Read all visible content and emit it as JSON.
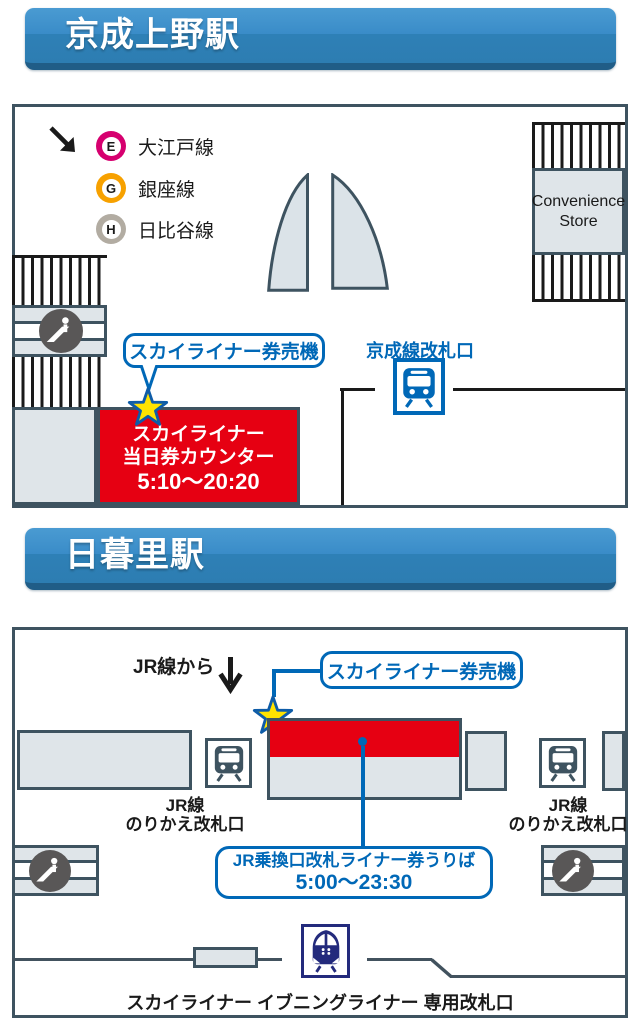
{
  "colors": {
    "accent_blue": "#0068b7",
    "counter_red": "#e60012",
    "star_yellow": "#ffe300",
    "star_outline_blue": "#0e5ca8",
    "slate_border": "#3e5360",
    "skyliner_navy": "#232a7c",
    "escalator_gray": "#595757",
    "header_blue_top": "#4a9bd2",
    "header_blue_bottom": "#2e80b6"
  },
  "station1": {
    "title": "京成上野駅",
    "subway_lines": [
      {
        "code": "E",
        "name": "大江戸線",
        "color": "#d6006f"
      },
      {
        "code": "G",
        "name": "銀座線",
        "color": "#f7a100"
      },
      {
        "code": "H",
        "name": "日比谷線",
        "color": "#b2aca2"
      }
    ],
    "convenience_store": "Convenience Store",
    "ticket_machine_label": "スカイライナー券売機",
    "gate_label": "京成線改札口",
    "counter_line1": "スカイライナー",
    "counter_line2": "当日券カウンター",
    "counter_hours": "5:10〜20:20"
  },
  "station2": {
    "title": "日暮里駅",
    "from_jr_label": "JR線から",
    "ticket_machine_label": "スカイライナー券売機",
    "jr_gate_line1": "JR線",
    "jr_gate_line2": "のりかえ改札口",
    "liner_counter_line1": "JR乗換口改札ライナー券うりば",
    "liner_counter_hours": "5:00〜23:30",
    "exclusive_gate_label": "スカイライナー イブニングライナー 専用改札口"
  },
  "icons": [
    "southeast-arrow-icon",
    "down-arrow-icon",
    "escalator-icon",
    "train-icon",
    "skyliner-train-icon",
    "star-marker",
    "door-leaf",
    "stairs-hatch"
  ]
}
